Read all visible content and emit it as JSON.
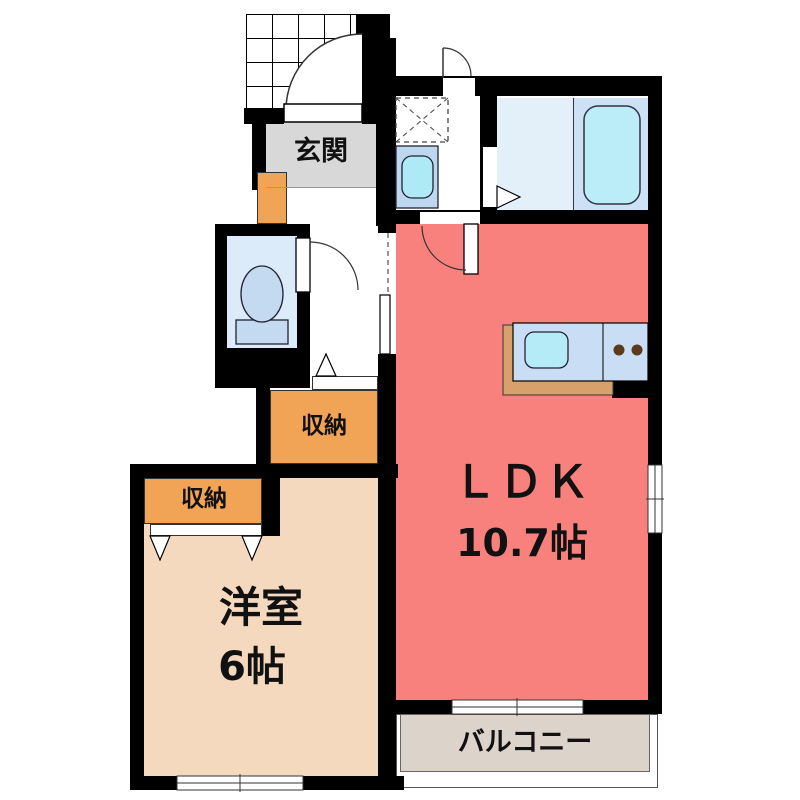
{
  "plan": {
    "rooms": {
      "entrance": {
        "label": "玄関",
        "color": "#D8D8D8"
      },
      "ldk": {
        "label": "ＬＤＫ",
        "size": "10.7帖",
        "color": "#F9817D"
      },
      "western_room": {
        "label": "洋室",
        "size": "6帖",
        "color": "#F4D9BE"
      },
      "hall_storage": {
        "label": "収納",
        "color": "#F1A356"
      },
      "room_storage": {
        "label": "収納",
        "color": "#F1A356"
      },
      "balcony": {
        "label": "バルコニー",
        "color": "#DCD4CB"
      },
      "bathroom": {
        "color": "#CDE1F6"
      },
      "washroom": {
        "color": "#FFFFFF"
      },
      "toilet_room": {
        "color": "#DCEBF9"
      }
    },
    "fixtures": {
      "bathtub": "bathtub",
      "toilet": "toilet",
      "vanity_sink": "vanity-sink",
      "kitchen_sink": "kitchen-sink",
      "kitchen_burners": "two-burner-cooktop",
      "washing_machine_space": "washing-machine-space",
      "shoe_cabinet": "shoe-cabinet"
    },
    "palette": {
      "wall": "#000000",
      "tub_water": "#BAEDF8",
      "sink_water": "#B5EBF7",
      "fixture_blue": "#C3DAF1",
      "counter": "#C9DEF4",
      "counter_edge": "#D8A06B",
      "burner": "#5C3A1E"
    }
  }
}
